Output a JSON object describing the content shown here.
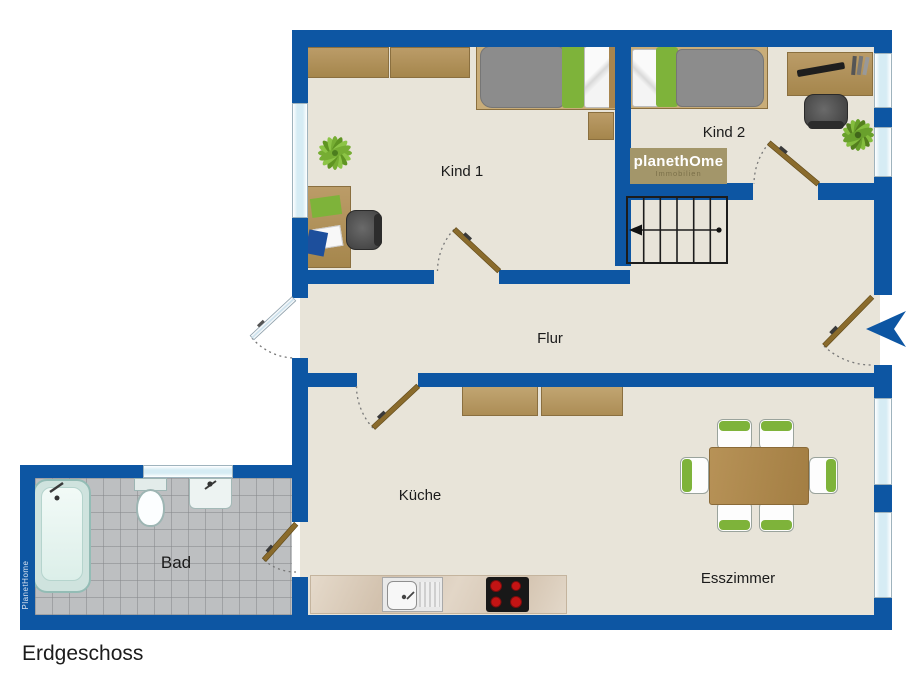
{
  "floor_plan": {
    "floor_label": "Erdgeschoss",
    "rooms": {
      "kind1": "Kind 1",
      "kind2": "Kind 2",
      "flur": "Flur",
      "kueche": "Küche",
      "bad": "Bad",
      "esszimmer": "Esszimmer"
    },
    "brand": {
      "logo_main": "planethOme",
      "logo_sub": "Immobilien",
      "wall_watermark": "PlanetHome"
    },
    "colors": {
      "wall_blue": "#0d56a3",
      "floor_beige": "#e8e4d9",
      "bath_tile_gray": "#bdbfc1",
      "wood_brown": "#b2935c",
      "door_wood_brown": "#8a6b2c",
      "accent_green": "#7eb33a",
      "logo_gold": "#a3966a",
      "duvet_gray": "#8c8c8c",
      "stove_red": "#c41414",
      "window_pane_blue": "#d6ecf4"
    }
  }
}
